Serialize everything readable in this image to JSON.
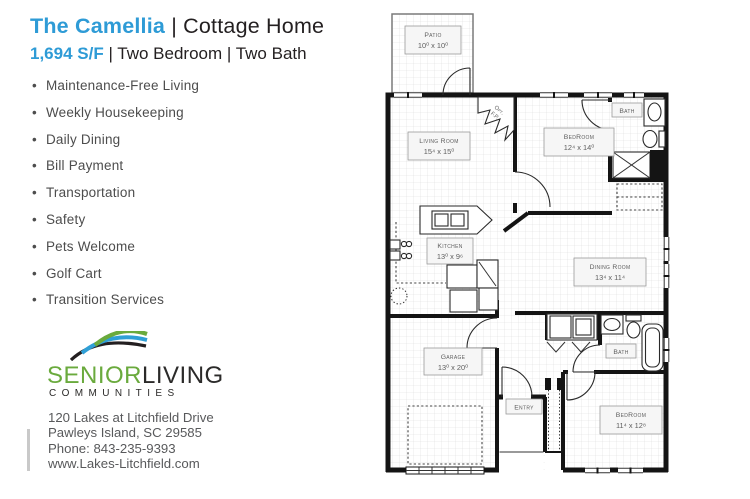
{
  "header": {
    "title_accent": "The Camellia",
    "title_rest": " | Cottage Home",
    "subtitle_accent": "1,694 S/F",
    "subtitle_rest": " | Two Bedroom | Two Bath"
  },
  "amenities": [
    "Maintenance-Free Living",
    "Weekly Housekeeping",
    "Daily Dining",
    "Bill Payment",
    "Transportation",
    "Safety",
    "Pets Welcome",
    "Golf Cart",
    "Transition Services"
  ],
  "logo": {
    "word_senior": "SENIOR",
    "word_living": "LIVING",
    "word_communities": "COMMUNITIES"
  },
  "contact": {
    "address_line1": "120 Lakes at Litchfield Drive",
    "address_line2": "Pawleys Island, SC 29585",
    "phone": "Phone: 843-235-9393",
    "website": "www.Lakes-Litchfield.com"
  },
  "colors": {
    "accent_blue": "#2E9BD6",
    "logo_green": "#6AAA3D",
    "logo_dark": "#231F20",
    "text_gray": "#58595B"
  },
  "floorplan": {
    "rooms": {
      "patio": {
        "name": "Patio",
        "dims": "10⁰ x 10⁰"
      },
      "living": {
        "name": "Living Room",
        "dims": "15⁴ x 15⁰"
      },
      "bedroom1": {
        "name": "BedRoom",
        "dims": "12⁴ x 14⁰"
      },
      "bath1": {
        "name": "Bath"
      },
      "kitchen": {
        "name": "Kitchen",
        "dims": "13⁰ x 9⁶"
      },
      "dining": {
        "name": "Dining Room",
        "dims": "13⁴ x 11⁴"
      },
      "garage": {
        "name": "Garage",
        "dims": "13⁰ x 20⁰"
      },
      "entry": {
        "name": "Entry"
      },
      "bath2": {
        "name": "Bath"
      },
      "bedroom2": {
        "name": "BedRoom",
        "dims": "11⁴ x 12⁸"
      },
      "fireplace": {
        "line1": "Opt.",
        "line2": "F.P."
      }
    }
  }
}
